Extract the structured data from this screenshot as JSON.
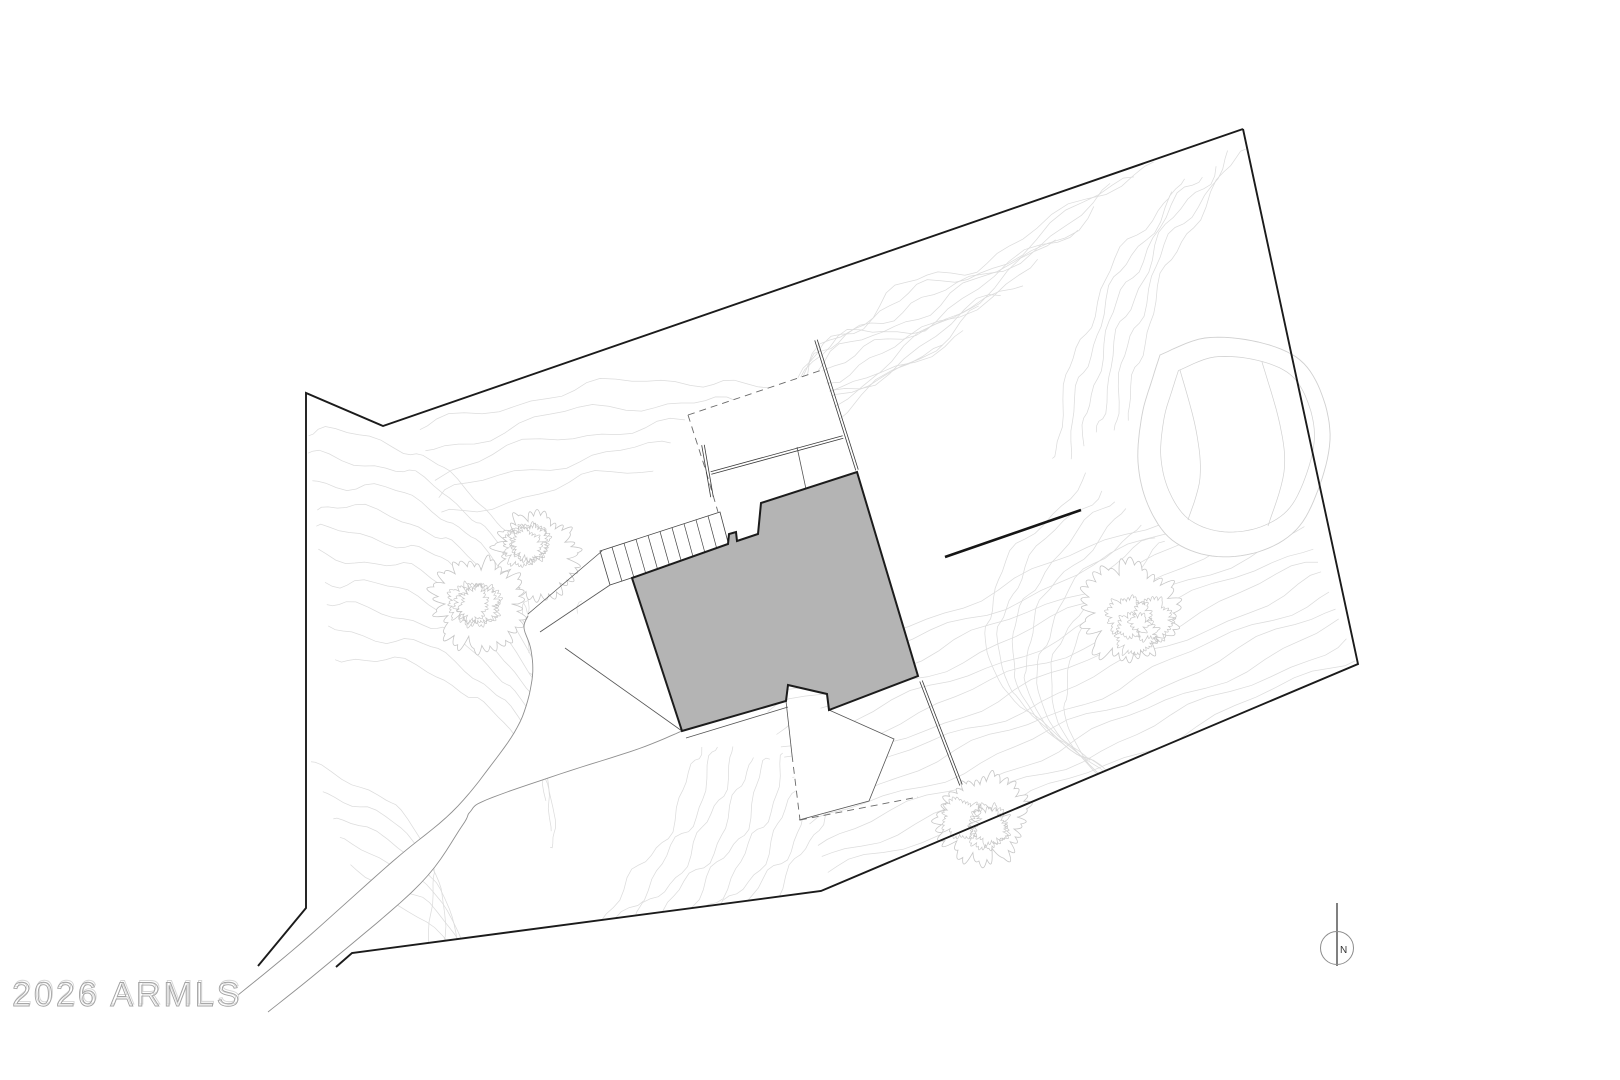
{
  "canvas": {
    "width": 1620,
    "height": 1080,
    "background": "#ffffff"
  },
  "watermark": {
    "text": "2026 ARMLS",
    "x": 12,
    "y": 1006,
    "stroke": "#a3a3a3",
    "ghost_stroke": "#d6d6d6"
  },
  "north_arrow": {
    "label": "N",
    "cx": 1337,
    "cy": 948,
    "radius": 16.5,
    "line_top": 903,
    "line_bottom": 966,
    "circle_color": "#8d8d8d",
    "line_color": "#4a4a4a",
    "label_color": "#333333",
    "label_size": 10
  },
  "colors": {
    "boundary": "#1b1b1b",
    "contour": "#dcdcdc",
    "driveway_edge": "#8f8f8f",
    "thin_line": "#555555",
    "dashed_line": "#6a6a6a",
    "wall": "#3a3a3a",
    "building_fill": "#b4b4b4",
    "building_stroke": "#1c1c1c",
    "tree": "#c6c6c6",
    "rock": "#d0d0d0",
    "site_wall": "#151515"
  },
  "site": {
    "boundary_left": [
      [
        1243,
        129
      ],
      [
        383,
        426
      ],
      [
        306,
        393
      ],
      [
        306,
        908
      ],
      [
        258,
        966
      ]
    ],
    "boundary_right": [
      [
        336,
        967
      ],
      [
        352,
        953
      ],
      [
        821,
        891
      ],
      [
        1358,
        664
      ],
      [
        1243,
        129
      ]
    ],
    "boundary_width": 1.9,
    "contour_families": [
      {
        "base": [
          [
            840,
            905
          ],
          [
            1010,
            842
          ],
          [
            1190,
            766
          ],
          [
            1365,
            688
          ]
        ],
        "count": 15,
        "offset": [
          -6,
          -16
        ],
        "amp": 4
      },
      {
        "base": [
          [
            306,
            430
          ],
          [
            400,
            446
          ],
          [
            472,
            494
          ],
          [
            522,
            562
          ],
          [
            524,
            624
          ]
        ],
        "count": 10,
        "offset": [
          3,
          25
        ],
        "amp": 5
      },
      {
        "base": [
          [
            312,
            764
          ],
          [
            392,
            804
          ],
          [
            434,
            872
          ],
          [
            424,
            950
          ]
        ],
        "count": 6,
        "offset": [
          10,
          26
        ],
        "amp": 4
      },
      {
        "base": [
          [
            1152,
            158
          ],
          [
            1010,
            248
          ],
          [
            898,
            292
          ],
          [
            818,
            362
          ],
          [
            788,
            432
          ]
        ],
        "count": 12,
        "offset": [
          -19,
          17
        ],
        "amp": 6
      },
      {
        "base": [
          [
            1246,
            150
          ],
          [
            1186,
            232
          ],
          [
            1146,
            330
          ],
          [
            1128,
            420
          ]
        ],
        "count": 6,
        "offset": [
          -15,
          8
        ],
        "amp": 5
      },
      {
        "base": [
          [
            1088,
            478
          ],
          [
            1012,
            556
          ],
          [
            986,
            636
          ],
          [
            1014,
            700
          ],
          [
            1088,
            756
          ]
        ],
        "count": 7,
        "offset": [
          13,
          11
        ],
        "amp": 4
      },
      {
        "base": [
          [
            700,
            743
          ],
          [
            674,
            818
          ],
          [
            624,
            890
          ],
          [
            566,
            952
          ]
        ],
        "count": 9,
        "offset": [
          17,
          3
        ],
        "amp": 5
      },
      {
        "base": [
          [
            420,
            430
          ],
          [
            560,
            392
          ],
          [
            700,
            380
          ],
          [
            800,
            400
          ]
        ],
        "count": 5,
        "offset": [
          6,
          22
        ],
        "amp": 5
      }
    ],
    "driveway": {
      "left_edge": [
        [
          238,
          995
        ],
        [
          300,
          944
        ],
        [
          392,
          862
        ],
        [
          452,
          812
        ],
        [
          492,
          764
        ],
        [
          520,
          722
        ],
        [
          532,
          680
        ],
        [
          531,
          650
        ],
        [
          524,
          628
        ],
        [
          528,
          616
        ]
      ],
      "right_edge": [
        [
          268,
          1012
        ],
        [
          330,
          962
        ],
        [
          420,
          884
        ],
        [
          462,
          826
        ],
        [
          470,
          812
        ],
        [
          486,
          800
        ],
        [
          560,
          774
        ],
        [
          638,
          749
        ],
        [
          682,
          731
        ]
      ]
    },
    "building": {
      "footprint": [
        [
          632,
          578
        ],
        [
          728,
          544
        ],
        [
          729,
          534
        ],
        [
          736,
          532
        ],
        [
          737,
          541
        ],
        [
          758,
          534
        ],
        [
          761,
          503
        ],
        [
          857,
          472
        ],
        [
          918,
          676
        ],
        [
          829,
          710
        ],
        [
          827,
          694
        ],
        [
          788,
          685
        ],
        [
          786,
          701
        ],
        [
          682,
          731
        ]
      ],
      "stroke_width": 2
    },
    "stairs": {
      "quad": [
        [
          600,
          551
        ],
        [
          720,
          512
        ],
        [
          729,
          546
        ],
        [
          610,
          585
        ]
      ],
      "treads": 10,
      "rail_extensions": [
        [
          [
            602,
            551
          ],
          [
            528,
            614
          ]
        ],
        [
          [
            610,
            585
          ],
          [
            540,
            632
          ]
        ]
      ]
    },
    "upper_terrace": {
      "white": [
        [
          605,
          549
        ],
        [
          688,
          415
        ],
        [
          822,
          370
        ],
        [
          857,
          470
        ],
        [
          761,
          504
        ],
        [
          720,
          512
        ]
      ],
      "dashed": [
        [
          [
            688,
            415
          ],
          [
            822,
            370
          ]
        ],
        [
          [
            688,
            415
          ],
          [
            705,
            468
          ],
          [
            718,
            512
          ]
        ]
      ],
      "double_walls": [
        [
          [
            816,
            340
          ],
          [
            857,
            470
          ]
        ],
        [
          [
            711,
            473
          ],
          [
            843,
            437
          ]
        ],
        [
          [
            703,
            445
          ],
          [
            712,
            497
          ]
        ]
      ],
      "thin_lines": [
        [
          [
            797,
            447
          ],
          [
            812,
            517
          ]
        ]
      ]
    },
    "lower_courtyard": {
      "white": [
        [
          786,
          701
        ],
        [
          829,
          710
        ],
        [
          894,
          739
        ],
        [
          869,
          801
        ],
        [
          799,
          820
        ]
      ],
      "white_patches": [
        [
          [
            600,
            551
          ],
          [
            565,
            648
          ],
          [
            682,
            731
          ],
          [
            634,
            578
          ]
        ]
      ],
      "solid_lines": [
        [
          [
            829,
            710
          ],
          [
            894,
            739
          ],
          [
            869,
            801
          ],
          [
            799,
            820
          ]
        ],
        [
          [
            786,
            701
          ],
          [
            792,
            755
          ]
        ],
        [
          [
            686,
            738
          ],
          [
            788,
            707
          ]
        ],
        [
          [
            565,
            648
          ],
          [
            682,
            731
          ]
        ]
      ],
      "dashed_lines": [
        [
          [
            792,
            755
          ],
          [
            800,
            820
          ]
        ],
        [
          [
            800,
            820
          ],
          [
            918,
            797
          ]
        ]
      ],
      "double_walls": [
        [
          [
            921,
            681
          ],
          [
            961,
            785
          ]
        ]
      ]
    },
    "site_wall": {
      "from": [
        945,
        557
      ],
      "to": [
        1081,
        510
      ],
      "width": 2.6
    },
    "trees": [
      {
        "cx": 537,
        "cy": 553,
        "r": 42
      },
      {
        "cx": 478,
        "cy": 604,
        "r": 46
      },
      {
        "cx": 1130,
        "cy": 613,
        "r": 48
      },
      {
        "cx": 983,
        "cy": 817,
        "r": 45
      }
    ],
    "rock": {
      "outline": [
        [
          1160,
          355
        ],
        [
          1205,
          338
        ],
        [
          1258,
          342
        ],
        [
          1300,
          360
        ],
        [
          1322,
          395
        ],
        [
          1330,
          440
        ],
        [
          1318,
          490
        ],
        [
          1296,
          530
        ],
        [
          1258,
          552
        ],
        [
          1212,
          556
        ],
        [
          1172,
          540
        ],
        [
          1148,
          505
        ],
        [
          1138,
          462
        ],
        [
          1142,
          415
        ],
        [
          1152,
          380
        ]
      ],
      "creases": [
        [
          [
            1180,
            370
          ],
          [
            1196,
            430
          ],
          [
            1200,
            478
          ],
          [
            1188,
            520
          ]
        ],
        [
          [
            1262,
            362
          ],
          [
            1280,
            425
          ],
          [
            1284,
            472
          ],
          [
            1268,
            526
          ]
        ]
      ]
    }
  }
}
